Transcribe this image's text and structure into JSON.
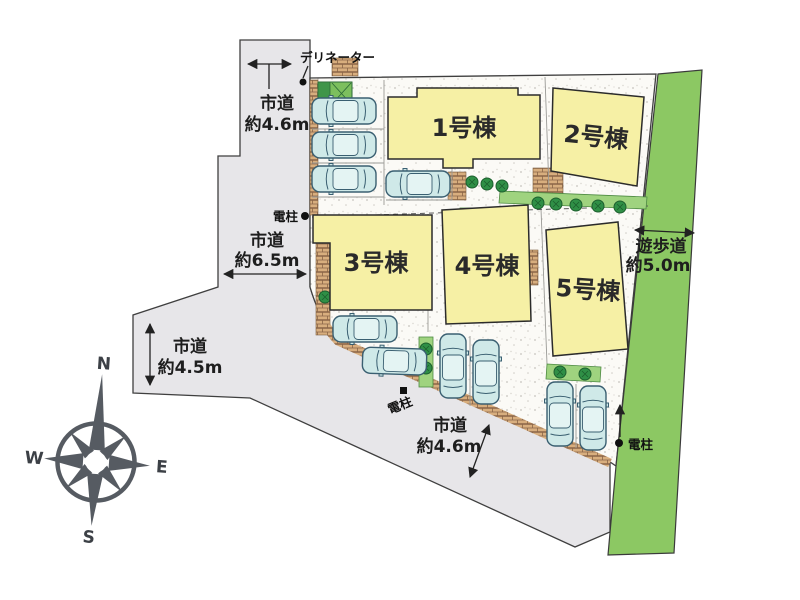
{
  "plan": {
    "buildings": [
      {
        "label": "1号棟"
      },
      {
        "label": "2号棟"
      },
      {
        "label": "3号棟"
      },
      {
        "label": "4号棟"
      },
      {
        "label": "5号棟"
      }
    ],
    "roads": {
      "north": {
        "name": "市道",
        "width": "約4.6m"
      },
      "west": {
        "name": "市道",
        "width": "約6.5m"
      },
      "southwest": {
        "name": "市道",
        "width": "約4.5m"
      },
      "south": {
        "name": "市道",
        "width": "約4.6m"
      },
      "promenade": {
        "name": "遊歩道",
        "width": "約5.0m"
      }
    },
    "markers": {
      "delineator": "デリネーター",
      "pole_west": "電柱",
      "pole_south": "電柱",
      "pole_east": "電柱"
    },
    "compass": {
      "n": "N",
      "e": "E",
      "s": "S",
      "w": "W"
    },
    "colors": {
      "road": "#e7e6e9",
      "building": "#f6f0a5",
      "promenade_green": "#8cc863",
      "grass": "#9fd37f",
      "tree": "#2f8f46",
      "car": "#cfe9e8",
      "curb_brick": "#d8ae7e",
      "line": "#222222"
    }
  }
}
